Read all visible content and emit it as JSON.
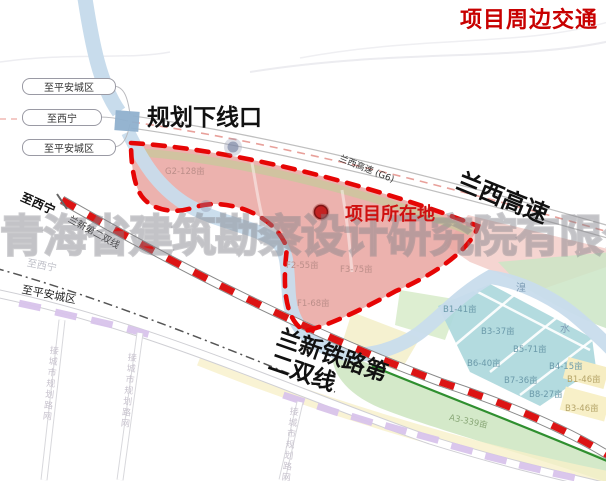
{
  "title": "项目周边交通",
  "signs": {
    "to_pingan_top": "至平安城区",
    "to_xining_mid": "至西宁",
    "to_pingan_mid": "至平安城区",
    "to_pingan_bottom": "至平安城区",
    "to_xining_rail": "至西宁",
    "to_xining_faint": "至西宁"
  },
  "annotations": {
    "planned_exit": "规划下线口",
    "project_location": "项目所在地",
    "expressway": "兰西高速",
    "expressway_road_tag": "兰西高速 (G6)",
    "railway_line1": "兰新铁路第",
    "railway_line2": "二双线",
    "railway_road_tag": "兰新第二双线",
    "connect_road": "接城市规划路网"
  },
  "river_labels": {
    "huang": "湟",
    "shui": "水"
  },
  "parcels": [
    {
      "label": "G2-128亩"
    },
    {
      "label": "F2-55亩"
    },
    {
      "label": "F3-75亩"
    },
    {
      "label": "F1-68亩"
    },
    {
      "label": "B1-41亩"
    },
    {
      "label": "B3-37亩"
    },
    {
      "label": "B5-71亩"
    },
    {
      "label": "B6-40亩"
    },
    {
      "label": "B4-15亩"
    },
    {
      "label": "B7-36亩"
    },
    {
      "label": "B8-27亩"
    },
    {
      "label": "B1-46亩"
    },
    {
      "label": "B3-46亩"
    },
    {
      "label": "A3-339亩"
    }
  ],
  "watermark": "青海省建筑勘察设计研究院有限公司",
  "colors": {
    "title_red": "#c80000",
    "boundary_red": "#e60505",
    "railway_red": "#dc1414",
    "project_pink": "#e9a5a0",
    "river_blue": "#c8dcec",
    "teal_parcel": "#abd7db",
    "green_zone": "#cfe7c3",
    "bridge_blue": "#8fb0cd"
  }
}
